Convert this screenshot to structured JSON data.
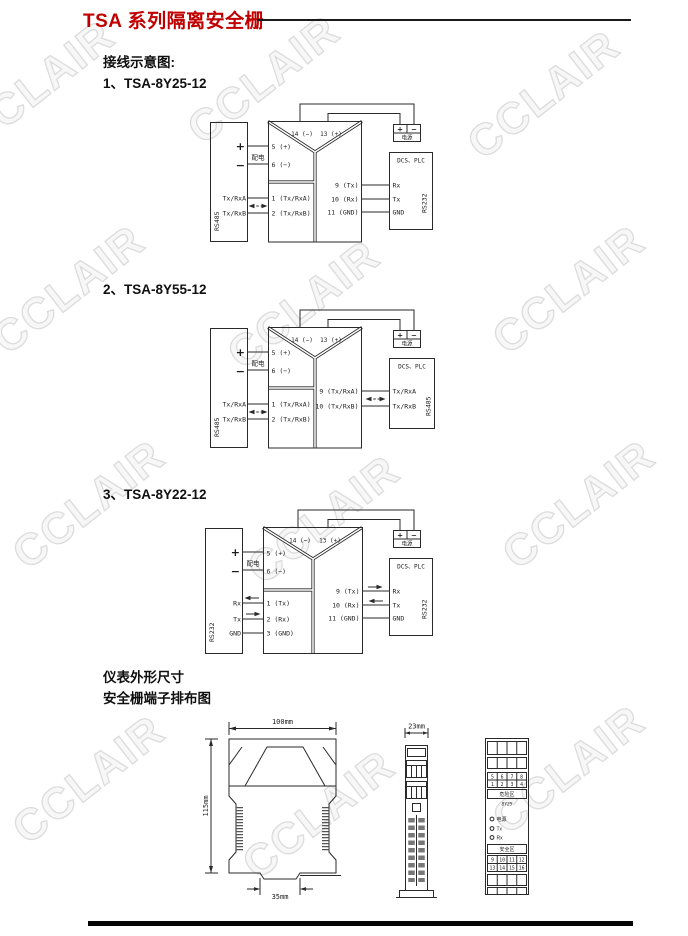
{
  "page": {
    "title": "TSA 系列隔离安全栅",
    "wiring_heading": "接线示意图:",
    "outline_heading": "仪表外形尺寸",
    "terminal_heading": "安全栅端子排布图",
    "watermark": "CCLAIR"
  },
  "diagram1": {
    "label": "1、TSA-8Y25-12",
    "left": {
      "bus": "RS485",
      "plus": "+",
      "minus": "−",
      "feed": "配电",
      "a": "Tx/RxA",
      "b": "Tx/RxB"
    },
    "module": {
      "t14": "14 (−)",
      "t13": "13 (+)",
      "t5": "5 (+)",
      "t6": "6 (−)",
      "t1": "1 (Tx/RxA)",
      "t2": "2 (Tx/RxB)",
      "t9": "9 (Tx)",
      "t10": "10 (Rx)",
      "t11": "11 (GND)"
    },
    "right": {
      "title": "DCS、PLC",
      "r1": "Rx",
      "r2": "Tx",
      "r3": "GND",
      "bus": "RS232"
    },
    "supply": {
      "plus": "+",
      "minus": "−",
      "label": "电源"
    }
  },
  "diagram2": {
    "label": "2、TSA-8Y55-12",
    "left": {
      "bus": "RS485",
      "plus": "+",
      "minus": "−",
      "feed": "配电",
      "a": "Tx/RxA",
      "b": "Tx/RxB"
    },
    "module": {
      "t14": "14 (−)",
      "t13": "13 (+)",
      "t5": "5 (+)",
      "t6": "6 (−)",
      "t1": "1 (Tx/RxA)",
      "t2": "2 (Tx/RxB)",
      "t9": "9 (Tx/RxA)",
      "t10": "10 (Tx/RxB)"
    },
    "right": {
      "title": "DCS、PLC",
      "r1": "Tx/RxA",
      "r2": "Tx/RxB",
      "bus": "RS485"
    },
    "supply": {
      "plus": "+",
      "minus": "−",
      "label": "电源"
    }
  },
  "diagram3": {
    "label": "3、TSA-8Y22-12",
    "left": {
      "bus": "RS232",
      "plus": "+",
      "minus": "−",
      "feed": "配电",
      "a": "Rx",
      "b": "Tx",
      "c": "GND"
    },
    "module": {
      "t14": "14 (−)",
      "t13": "13 (+)",
      "t5": "5 (+)",
      "t6": "6 (−)",
      "t1": "1 (Tx)",
      "t2": "2 (Rx)",
      "t3": "3 (GND)",
      "t9": "9 (Tx)",
      "t10": "10 (Rx)",
      "t11": "11 (GND)"
    },
    "right": {
      "title": "DCS、PLC",
      "r1": "Rx",
      "r2": "Tx",
      "r3": "GND",
      "bus": "RS232"
    },
    "supply": {
      "plus": "+",
      "minus": "−",
      "label": "电源"
    }
  },
  "outline": {
    "front": {
      "width": "100mm",
      "height": "115mm",
      "rail": "35mm"
    },
    "side": {
      "width": "23mm"
    },
    "face": {
      "row_a": [
        "5",
        "6",
        "7",
        "8"
      ],
      "row_b": [
        "1",
        "2",
        "3",
        "4"
      ],
      "hazard_label": "危险区",
      "model": "8Y25",
      "led_power": "电源",
      "led_tx": "Tx",
      "led_rx": "Rx",
      "safe_label": "安全区",
      "row_c": [
        "9",
        "10",
        "11",
        "12"
      ],
      "row_d": [
        "13",
        "14",
        "15",
        "16"
      ]
    }
  }
}
